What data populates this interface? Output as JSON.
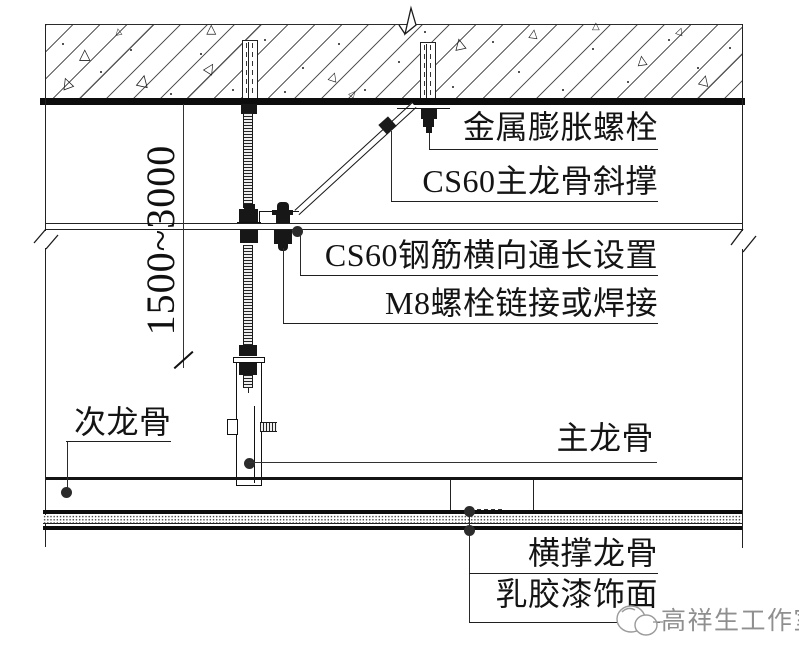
{
  "dimension": {
    "hanger_range": "1500~3000"
  },
  "labels": {
    "expansion_bolt": "金属膨胀螺栓",
    "main_keel_brace": "CS60主龙骨斜撑",
    "rebar_run": "CS60钢筋横向通长设置",
    "m8_bolt": "M8螺栓链接或焊接",
    "secondary_keel": "次龙骨",
    "main_keel": "主龙骨",
    "cross_support_keel": "横撑龙骨",
    "latex_paint_finish": "乳胶漆饰面"
  },
  "watermark": {
    "studio": "高祥生工作室"
  },
  "colors": {
    "line": "#1a1a1a",
    "thick_line": "#0d0d0d",
    "watermark": "#8f8f8f",
    "background": "#ffffff"
  }
}
